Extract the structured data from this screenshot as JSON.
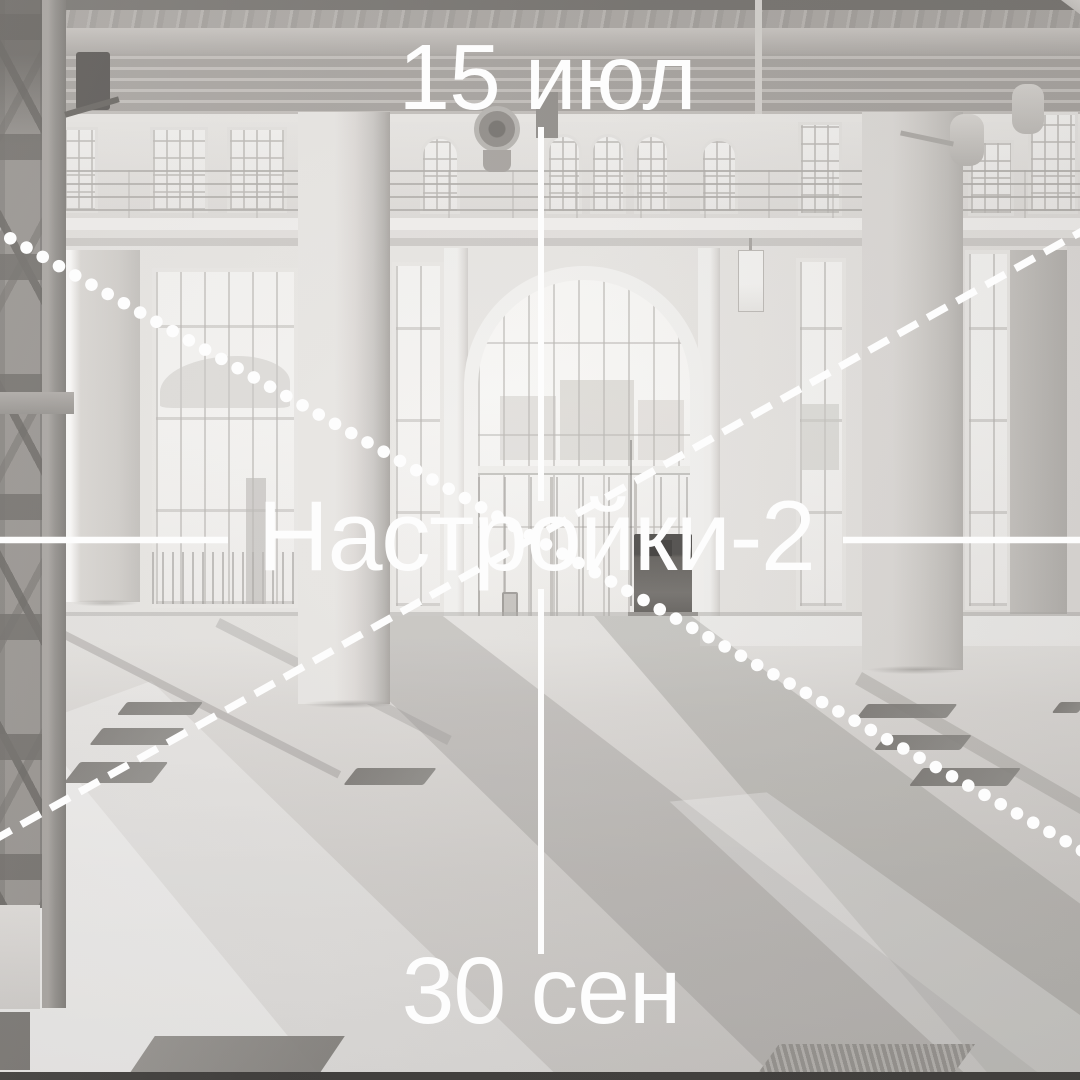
{
  "poster": {
    "top_date": "15 июл",
    "title": "Настройки-2",
    "bottom_date": "30 сен"
  },
  "overlay": {
    "color": "#fdfdfd",
    "lines": {
      "vertical_axis": "solid, interrupted by title and dates",
      "horizontal_axis": "solid, interrupted by title",
      "diagonal_top_left_to_bottom_right": "dotted",
      "diagonal_bottom_left_to_top_right": "dashed"
    }
  },
  "photo": {
    "subject": "empty white exhibition hall with concrete columns, arched glass wall and sunlit floor"
  }
}
